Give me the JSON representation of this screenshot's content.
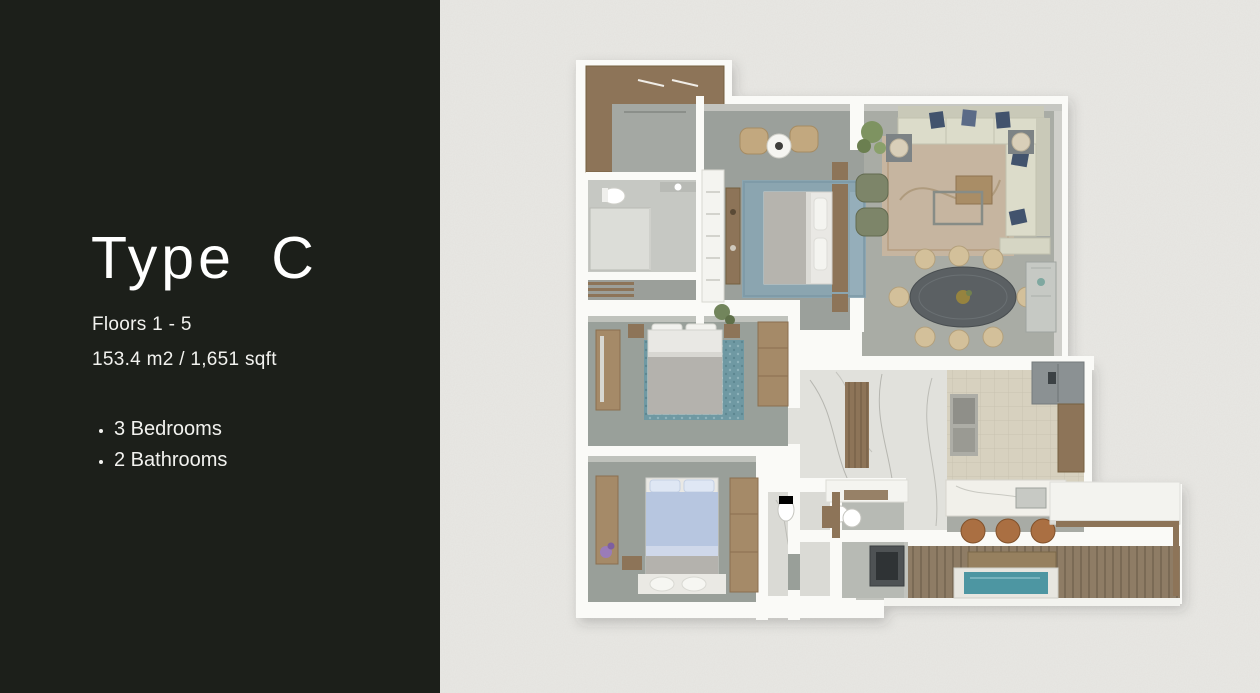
{
  "panel": {
    "title": "Type C",
    "floors_line": "Floors 1 - 5",
    "area_line": "153.4 m2 / 1,651 sqft",
    "features": [
      "3 Bedrooms",
      "2 Bathrooms"
    ],
    "colors": {
      "background": "#1c1f1a",
      "text": "#f5f5f2"
    }
  },
  "floorplan": {
    "description": "3D top-down render of apartment Type C",
    "background": "#e9e8e4",
    "rooms": [
      "walk-in-closet",
      "bathroom",
      "master-bedroom",
      "bedroom-2",
      "bedroom-3",
      "living-room",
      "dining-area",
      "kitchen",
      "hallway",
      "wc",
      "laundry",
      "terrace-deck"
    ],
    "palette": {
      "walls": "#fafaf7",
      "floor_gray": "#9ba09b",
      "wood": "#8d7458",
      "marble": "#e1e1dc",
      "deck": "#8e7c65",
      "rug_teal": "#6f99a3",
      "rug_blue": "#8aa5b2",
      "sofa_cream": "#dcdcca",
      "pillow_navy": "#42536d",
      "dining_table": "#5b6063",
      "water": "#4d96a2"
    }
  }
}
